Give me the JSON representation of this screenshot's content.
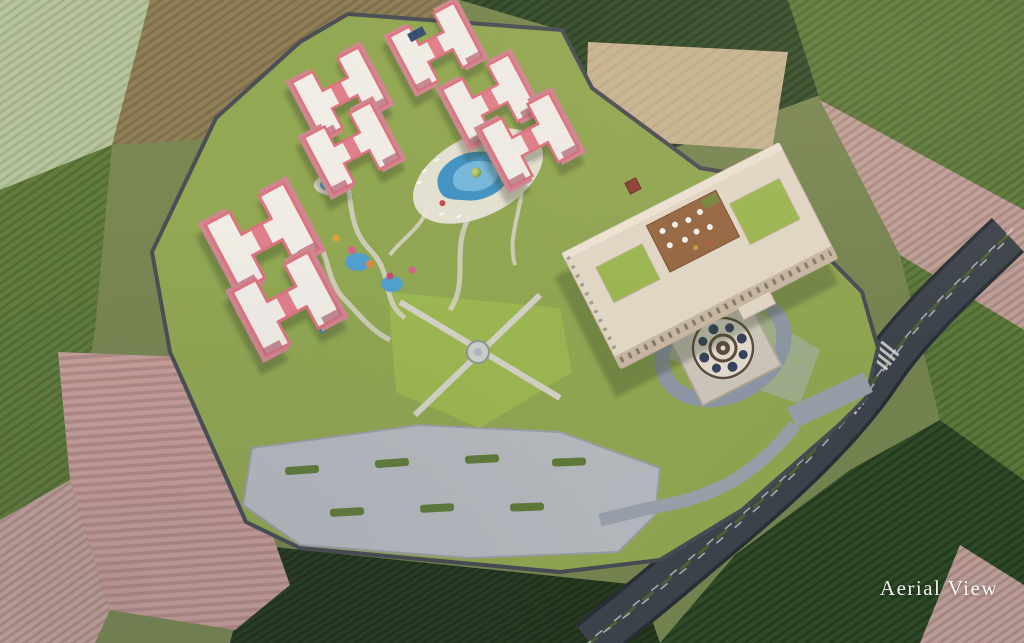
{
  "caption": {
    "label": "Aerial View"
  },
  "scene": {
    "type": "architectural-aerial-rendering",
    "subject": "Resort and residential masterplan seen from above, surrounded by farmland, at golden hour",
    "features": [
      {
        "name": "pink-apartment-blocks",
        "count": 7,
        "description": "H-shaped salmon-pink residential buildings with white roofs"
      },
      {
        "name": "main-clubhouse-building",
        "description": "large cream courtyard building with arched arcade"
      },
      {
        "name": "rooftop-terrace-restaurant",
        "description": "wood deck terrace with umbrellas on clubhouse roof"
      },
      {
        "name": "swimming-pool",
        "description": "resort pool with white sun deck and loungers"
      },
      {
        "name": "kids-water-play-garden",
        "description": "small pools, slides and colorful parasols in winding gardens"
      },
      {
        "name": "formal-lawn-with-fountain",
        "description": "lawn quad with crossing paths and circular fountain"
      },
      {
        "name": "ornamental-mosaic-plaza",
        "description": "circular decorative medallion at entrance drop-off"
      },
      {
        "name": "entrance-drop-off-loop",
        "description": "looping driveway connecting to public road"
      },
      {
        "name": "surface-parking-lot",
        "description": "striped parking rows with palm islands and parked cars"
      },
      {
        "name": "perimeter-tree-belt",
        "description": "dense trees and wall ringing the resort"
      },
      {
        "name": "public-road-with-traffic",
        "description": "curving dual road with median, crosswalks and cars"
      },
      {
        "name": "surrounding-farmland",
        "description": "striped crop fields, plowed pink field, hedgerows"
      }
    ]
  },
  "colors": {
    "base": "#75854e",
    "lawn": "#90a84f",
    "lawnBright": "#9cb94e",
    "treeDark": "#44622e",
    "treeMid": "#5d7d3c",
    "treeLight": "#a4c060",
    "palm": "#9fbf5a",
    "pinkWall": "#e59aa0",
    "pinkRoof": "#f3f0ea",
    "pinkTrim": "#e0707e",
    "cream": "#e6dcc9",
    "creamShadow": "#c6b59e",
    "terraceWood": "#96653f",
    "pool": "#3e93c6",
    "poolLight": "#7cc0e2",
    "asphalt": "#3a4149",
    "roadLine": "#e8e8e8",
    "pavement": "#98a1ab",
    "parking": "#b7bcc1",
    "wall": "#454a51",
    "plowPink": "#c79e98",
    "cropGreen": "#5d7a38",
    "cropGreenDark": "#2e4a24",
    "oliveField": "#8c7c52",
    "paleField": "#b4c49c",
    "pinkField": "#c2a29a",
    "darkField": "#24391d",
    "tanField": "#c9b691",
    "mosaicBase": "#e6dfd1",
    "mosaicDark": "#5a4a3a",
    "mosaicBlue": "#33405c",
    "captionColor": "#ffffff"
  }
}
